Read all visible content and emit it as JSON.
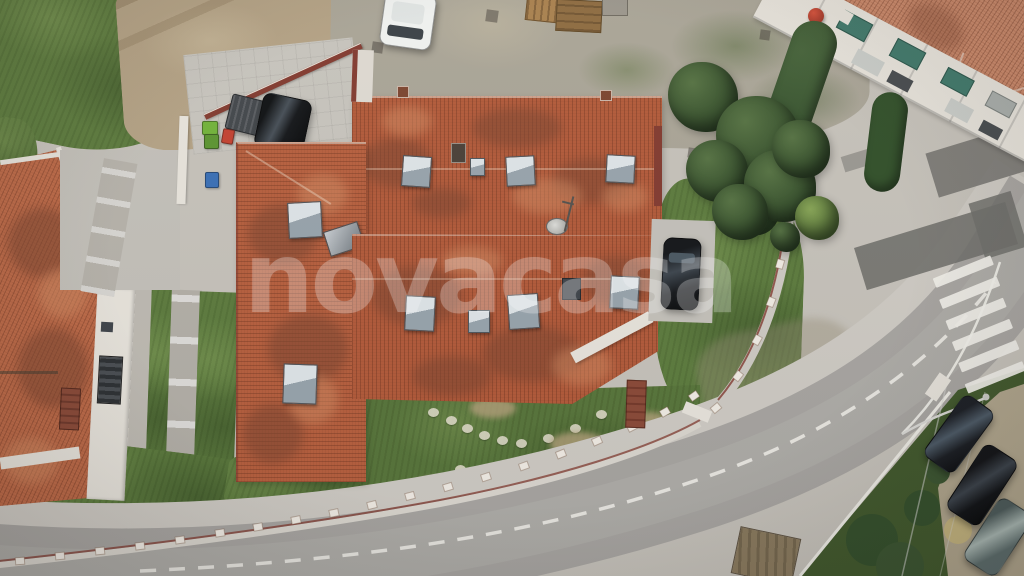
{
  "watermark": {
    "text": "novacasa"
  },
  "colors": {
    "base_concrete": "#c5c1b9",
    "road": "#a7a4a0",
    "road_worn": "#b3b0ac",
    "sidewalk": "#cdc9c2",
    "asphalt_patch": "#6f6e6a",
    "road_marking": "#f1efe9",
    "roof_main": "#b25a3a",
    "roof_main_dark": "#7c4530",
    "roof_main_light": "#d08a62",
    "roof_left": "#bd6a48",
    "roof_topright": "#c9886a",
    "grass": "#5d7b3e",
    "grass_dark": "#42592d",
    "grass_light": "#7d9a55",
    "hedge": "#3c5531",
    "tree_dark": "#35502c",
    "dirt": "#b3a184",
    "gravel": "#a9a496",
    "wall_white": "#e6e2da",
    "wall_maroon": "#823b30",
    "brick": "#8a4a38",
    "awning_teal": "#40786a",
    "ball_red": "#c24231",
    "car_black": "#1b1d20",
    "car_grey": "#5f6f6e",
    "car_white": "#eef0ee",
    "bin_green": "#72b23a",
    "bin_green2": "#5c9431",
    "bin_blue": "#3a6fb5",
    "skylight": "#aeb8be",
    "skylight_dark": "#5a6166",
    "equipment_dark": "#3f444a",
    "watermark_white": "#ffffff"
  }
}
